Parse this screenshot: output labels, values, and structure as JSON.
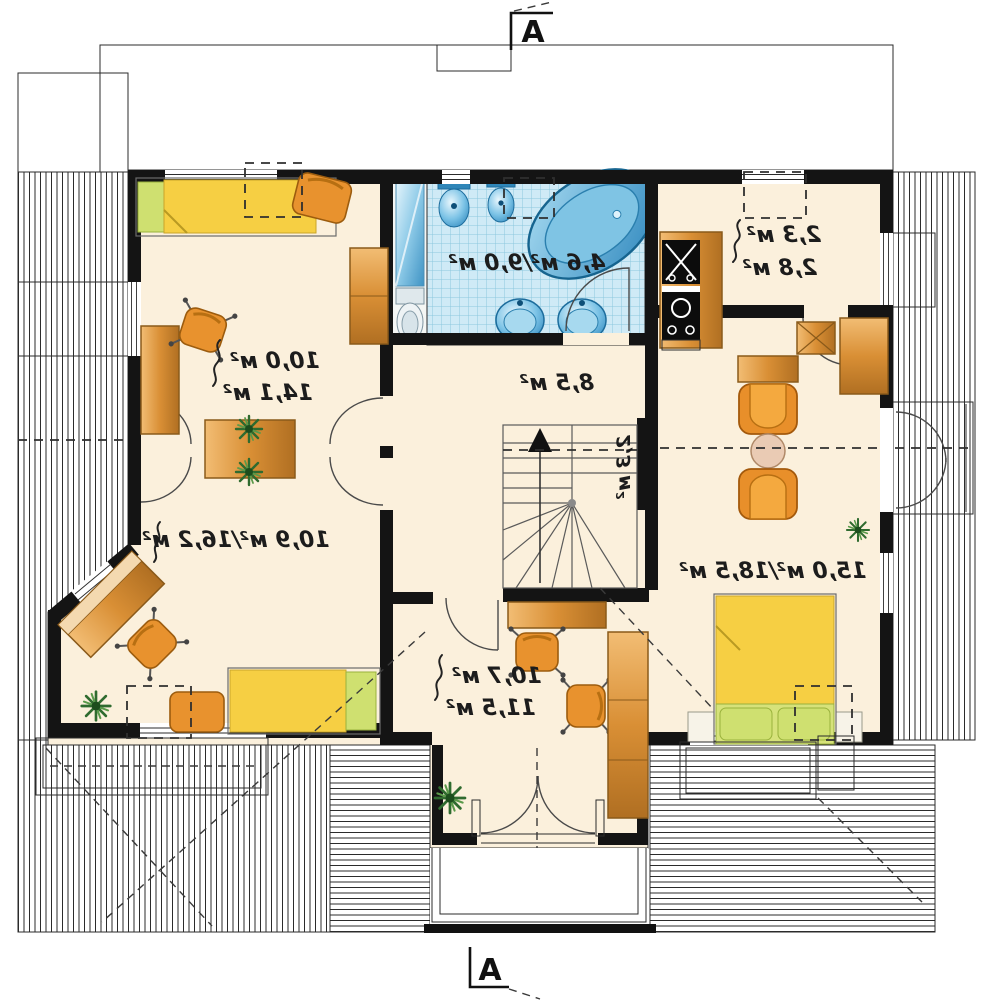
{
  "document": {
    "type": "architectural floor plan, attic storey (mirrored print)",
    "units": "м²"
  },
  "section_markers": {
    "top": "A",
    "bottom": "A"
  },
  "room_labels": {
    "bedroom_top_left_1": "10,0 м²",
    "bedroom_top_left_2": "14,1 м²",
    "bathroom": "4,6 м²/9,0 м²",
    "hall": "8,5 м²",
    "closet_1": "2,3 м²",
    "closet_2": "2,8 м²",
    "stairs": "2,3 м²",
    "room_bottom_left": "10,9 м²/16,2 м²",
    "living_right": "15,0 м²/18,5 м²",
    "room_bottom_center_1": "10,7 м²",
    "room_bottom_center_2": "11,5 м²"
  },
  "rooms": [
    {
      "name": "bedroom-top-left",
      "furniture": [
        "single-bed",
        "desk-chair",
        "office-chair",
        "desk",
        "wardrobe",
        "cabinet-with-plants"
      ]
    },
    {
      "name": "bathroom",
      "furniture": [
        "corner-bathtub",
        "washbasin",
        "washbasin",
        "toilet",
        "bidet",
        "shower-cabin",
        "wc-toilet"
      ]
    },
    {
      "name": "hall",
      "furniture": [
        "staircase",
        "up-arrow"
      ]
    },
    {
      "name": "closet-top-right",
      "furniture": [
        "kitchen-counter",
        "stove",
        "appliance",
        "cabinet",
        "wardrobe"
      ]
    },
    {
      "name": "living-room-right",
      "furniture": [
        "armchair",
        "armchair",
        "round-table",
        "sideboard",
        "double-bed",
        "nightstand",
        "nightstand",
        "plant"
      ]
    },
    {
      "name": "room-bottom-left",
      "furniture": [
        "corner-desk",
        "office-chair",
        "bed",
        "ottoman",
        "plant"
      ]
    },
    {
      "name": "room-bottom-center",
      "furniture": [
        "desk",
        "office-chair",
        "office-chair",
        "tall-wardrobe",
        "plant",
        "balcony-french-door"
      ]
    }
  ],
  "exterior": [
    "roof-hatching",
    "terrace-railing-left",
    "balcony-bottom-center",
    "railing-right"
  ],
  "colors": {
    "wall": "#141414",
    "floor": "#fbf0dc",
    "tile_bg": "#cfeaf6",
    "tile_line": "#8cc8de",
    "fixture_blue": "#3e9ccf",
    "furniture_orange": "#e8922e",
    "bed_yellow": "#f6cf43",
    "pillow_green": "#cfe070",
    "wood": "#d08a33",
    "plant_green": "#2f6b2f"
  }
}
